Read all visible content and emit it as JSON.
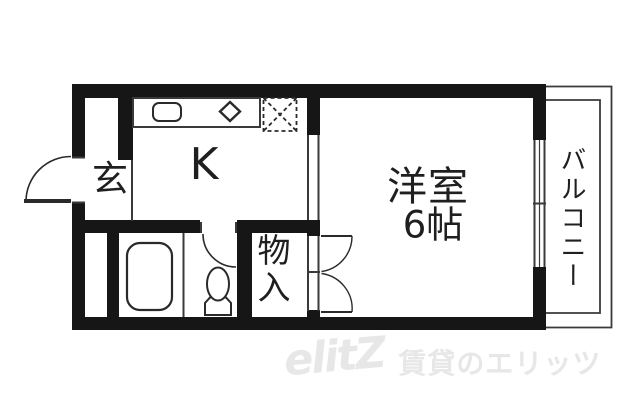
{
  "floorplan": {
    "labels": {
      "entrance": "玄",
      "kitchen": "K",
      "main_room": "洋室",
      "main_room_size": "6帖",
      "closet": "物入",
      "balcony": "バルコニー"
    },
    "watermark": {
      "logo": "elitZ",
      "text": "賃貸のエリッツ"
    },
    "colors": {
      "wall": "#161616",
      "thin_line": "#3a3a3a",
      "fixture_line": "#2a2a2a",
      "text": "#1f1f1f",
      "watermark": "#e7e7e7",
      "background": "#ffffff"
    },
    "fixtures": [
      "entrance-door",
      "kitchen-sink",
      "stove-burner",
      "refrigerator-space",
      "bathtub",
      "toilet",
      "toilet-door",
      "closet-double-door",
      "window",
      "balcony-railing"
    ]
  }
}
